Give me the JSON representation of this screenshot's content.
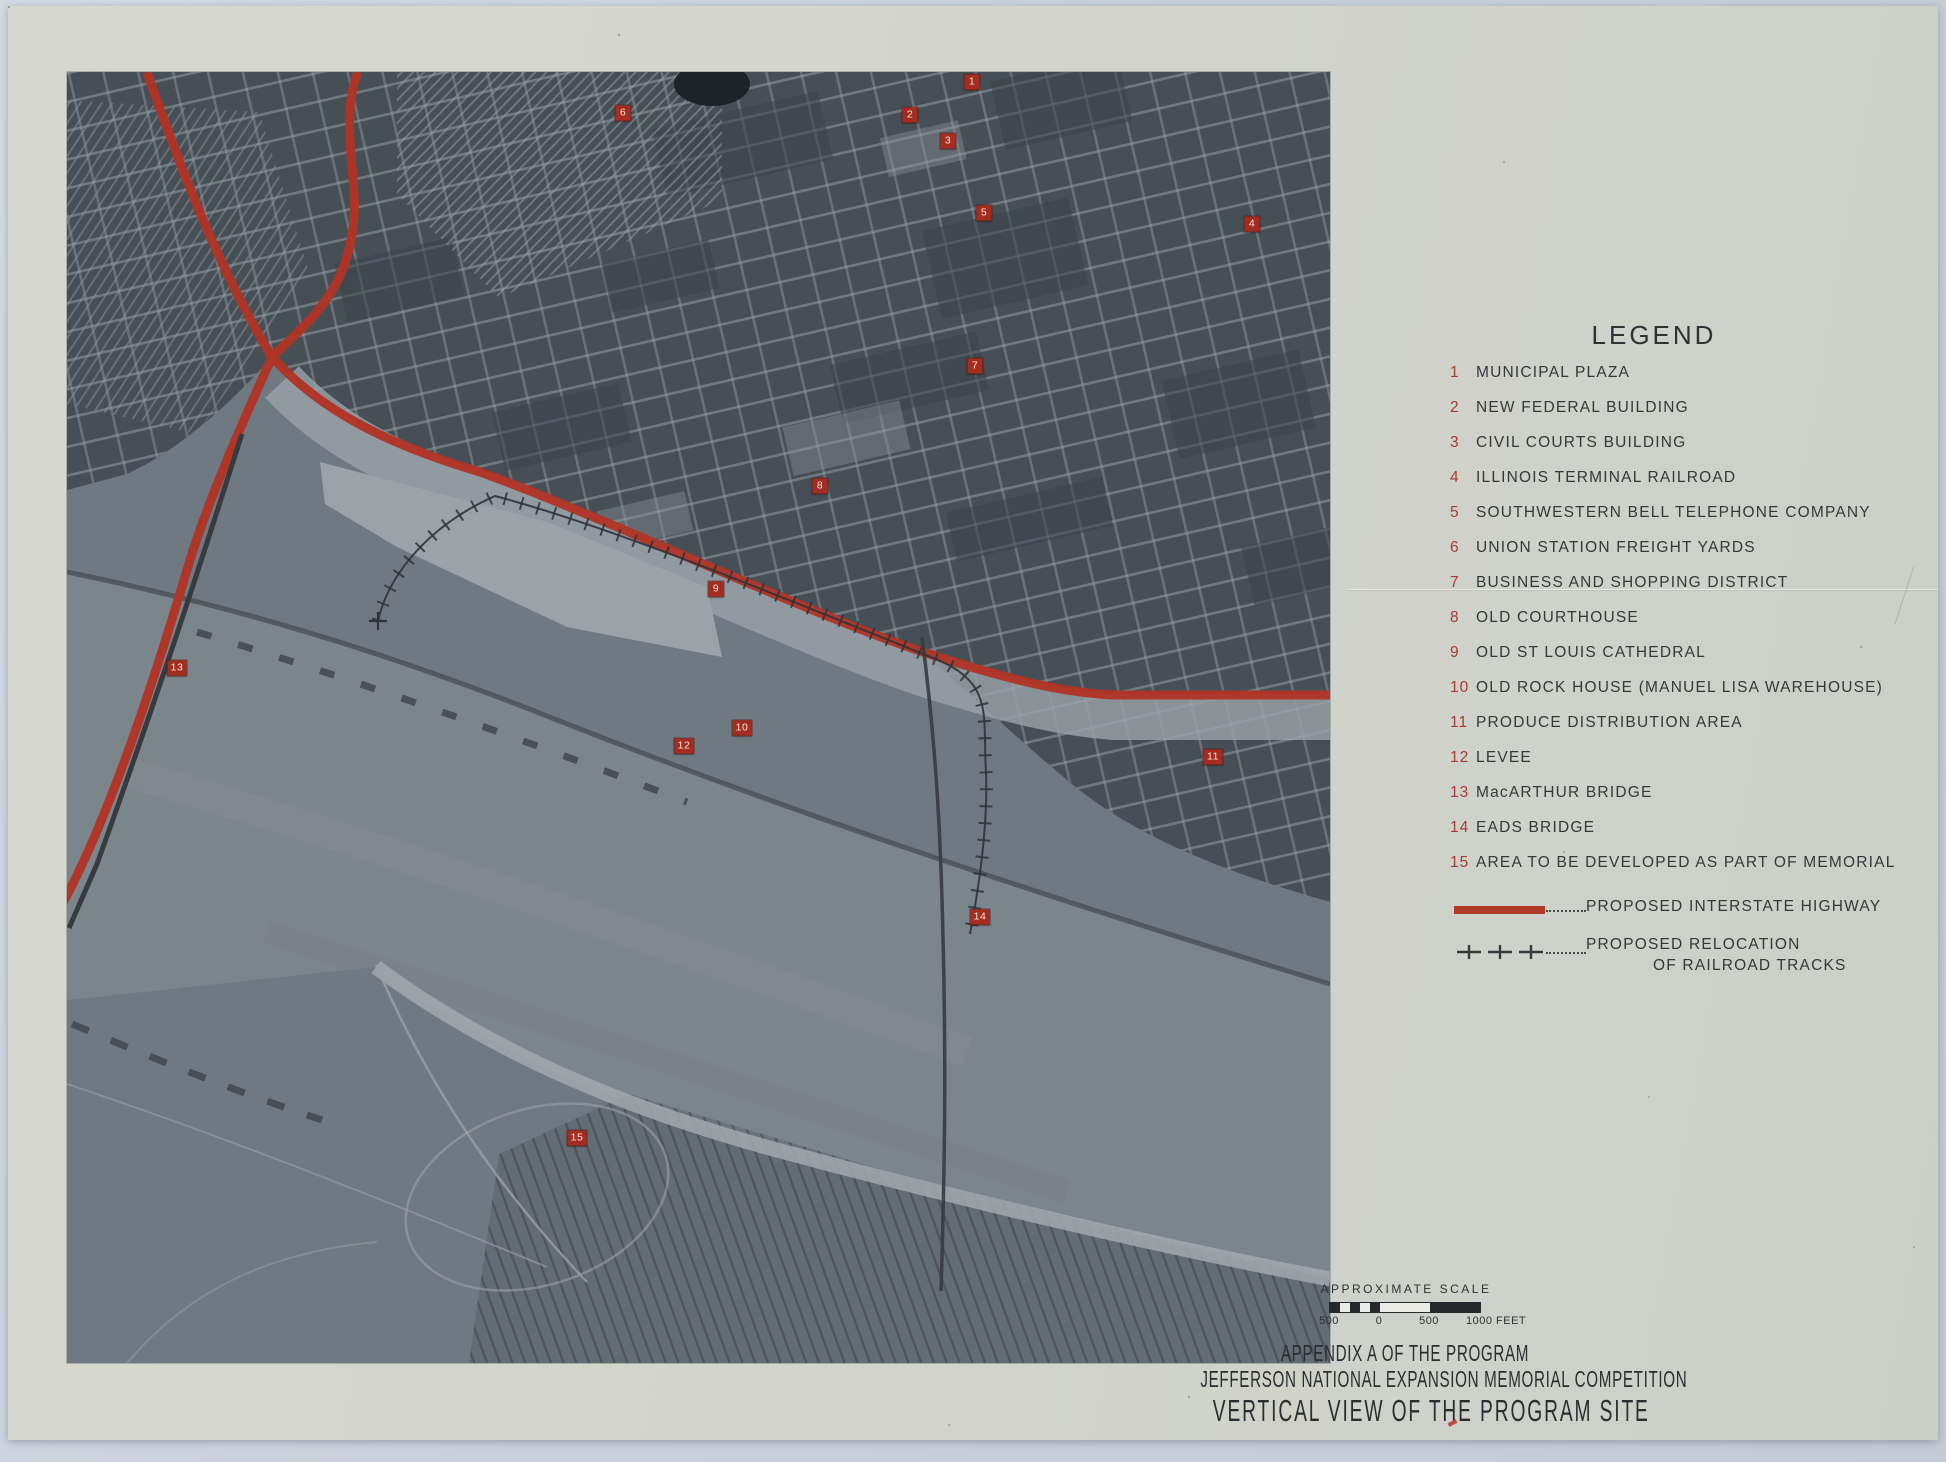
{
  "document": {
    "legend": {
      "title": "LEGEND",
      "items": [
        {
          "num": "1",
          "label": "MUNICIPAL PLAZA"
        },
        {
          "num": "2",
          "label": "NEW FEDERAL BUILDING"
        },
        {
          "num": "3",
          "label": "CIVIL COURTS BUILDING"
        },
        {
          "num": "4",
          "label": "ILLINOIS TERMINAL RAILROAD"
        },
        {
          "num": "5",
          "label": "SOUTHWESTERN BELL TELEPHONE COMPANY"
        },
        {
          "num": "6",
          "label": "UNION STATION FREIGHT YARDS"
        },
        {
          "num": "7",
          "label": "BUSINESS AND SHOPPING DISTRICT"
        },
        {
          "num": "8",
          "label": "OLD COURTHOUSE"
        },
        {
          "num": "9",
          "label": "OLD ST LOUIS CATHEDRAL"
        },
        {
          "num": "10",
          "label": "OLD ROCK HOUSE (MANUEL LISA WAREHOUSE)"
        },
        {
          "num": "11",
          "label": "PRODUCE DISTRIBUTION AREA"
        },
        {
          "num": "12",
          "label": "LEVEE"
        },
        {
          "num": "13",
          "label": "MacARTHUR BRIDGE"
        },
        {
          "num": "14",
          "label": "EADS BRIDGE"
        },
        {
          "num": "15",
          "label": "AREA TO BE DEVELOPED AS PART OF MEMORIAL"
        }
      ],
      "symbols": {
        "highway_label": "PROPOSED INTERSTATE HIGHWAY",
        "railroad_label_line1": "PROPOSED RELOCATION",
        "railroad_label_line2": "OF RAILROAD TRACKS"
      }
    },
    "scale": {
      "caption": "APPROXIMATE SCALE",
      "tick_labels": [
        "500",
        "0",
        "500",
        "1000 FEET"
      ]
    },
    "titles": {
      "line1": "APPENDIX A OF THE PROGRAM",
      "line2": "JEFFERSON NATIONAL EXPANSION MEMORIAL COMPETITION",
      "line3": "VERTICAL VIEW OF THE PROGRAM SITE"
    },
    "map_markers": [
      {
        "num": "1",
        "x": 905,
        "y": 10
      },
      {
        "num": "2",
        "x": 843,
        "y": 43
      },
      {
        "num": "3",
        "x": 881,
        "y": 69
      },
      {
        "num": "4",
        "x": 1185,
        "y": 152
      },
      {
        "num": "5",
        "x": 917,
        "y": 141
      },
      {
        "num": "6",
        "x": 556,
        "y": 41
      },
      {
        "num": "7",
        "x": 908,
        "y": 294
      },
      {
        "num": "8",
        "x": 753,
        "y": 414
      },
      {
        "num": "9",
        "x": 649,
        "y": 517
      },
      {
        "num": "10",
        "x": 675,
        "y": 656
      },
      {
        "num": "11",
        "x": 1146,
        "y": 685
      },
      {
        "num": "12",
        "x": 617,
        "y": 674
      },
      {
        "num": "13",
        "x": 110,
        "y": 596
      },
      {
        "num": "14",
        "x": 913,
        "y": 845
      },
      {
        "num": "15",
        "x": 510,
        "y": 1066
      }
    ],
    "colors": {
      "accent_red": "#b03a2a",
      "marker_red": "#a52c20",
      "legend_number_red": "#a83b2e",
      "ink": "#2e3234",
      "paper": "#d2d4cb",
      "scan_bed": "#c8d0d9",
      "photo_city": "#474f56",
      "photo_water": "#7b858c"
    }
  }
}
